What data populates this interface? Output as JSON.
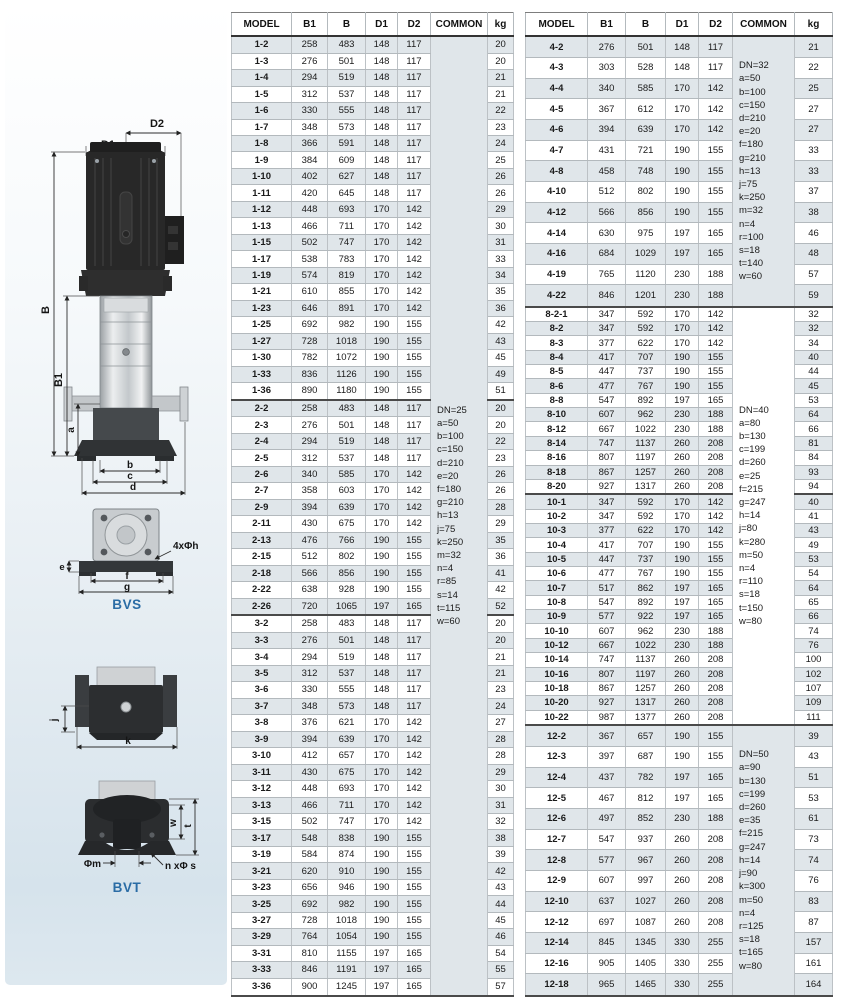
{
  "diagram": {
    "side_view": {
      "d2": "D2",
      "d1": "D1",
      "b": "B",
      "b1": "B1",
      "a": "a",
      "b_dim": "b",
      "c_dim": "c",
      "d_dim": "d"
    },
    "bvs": {
      "holes": "4xΦh",
      "e": "e",
      "f": "f",
      "g": "g",
      "label": "BVS"
    },
    "flange": {
      "j": "j",
      "k": "k"
    },
    "bvt": {
      "w": "w",
      "t": "t",
      "phi_m": "Φm",
      "n_phi_s": "n xΦ s",
      "label": "BVT"
    },
    "accent_color": "#2a6ca5"
  },
  "tables": [
    {
      "name": "left",
      "headers": [
        "MODEL",
        "B1",
        "B",
        "D1",
        "D2",
        "COMMON",
        "kg"
      ],
      "col_widths": [
        60,
        36,
        38,
        32,
        33,
        57,
        26
      ],
      "group_ends": [
        21,
        34
      ],
      "commons": [
        {
          "at": 0,
          "span": 58,
          "lines": [
            "DN=25",
            "a=50",
            "b=100",
            "c=150",
            "d=210",
            "e=20",
            "f=180",
            "g=210",
            "h=13",
            "j=75",
            "k=250",
            "m=32",
            "n=4",
            "r=85",
            "s=14",
            "t=115",
            "w=60"
          ]
        }
      ],
      "rows": [
        [
          "1-2",
          258,
          483,
          148,
          117,
          20
        ],
        [
          "1-3",
          276,
          501,
          148,
          117,
          20
        ],
        [
          "1-4",
          294,
          519,
          148,
          117,
          21
        ],
        [
          "1-5",
          312,
          537,
          148,
          117,
          21
        ],
        [
          "1-6",
          330,
          555,
          148,
          117,
          22
        ],
        [
          "1-7",
          348,
          573,
          148,
          117,
          23
        ],
        [
          "1-8",
          366,
          591,
          148,
          117,
          24
        ],
        [
          "1-9",
          384,
          609,
          148,
          117,
          25
        ],
        [
          "1-10",
          402,
          627,
          148,
          117,
          26
        ],
        [
          "1-11",
          420,
          645,
          148,
          117,
          26
        ],
        [
          "1-12",
          448,
          693,
          170,
          142,
          29
        ],
        [
          "1-13",
          466,
          711,
          170,
          142,
          30
        ],
        [
          "1-15",
          502,
          747,
          170,
          142,
          31
        ],
        [
          "1-17",
          538,
          783,
          170,
          142,
          33
        ],
        [
          "1-19",
          574,
          819,
          170,
          142,
          34
        ],
        [
          "1-21",
          610,
          855,
          170,
          142,
          35
        ],
        [
          "1-23",
          646,
          891,
          170,
          142,
          36
        ],
        [
          "1-25",
          692,
          982,
          190,
          155,
          42
        ],
        [
          "1-27",
          728,
          1018,
          190,
          155,
          43
        ],
        [
          "1-30",
          782,
          1072,
          190,
          155,
          45
        ],
        [
          "1-33",
          836,
          1126,
          190,
          155,
          49
        ],
        [
          "1-36",
          890,
          1180,
          190,
          155,
          51
        ],
        [
          "2-2",
          258,
          483,
          148,
          117,
          20
        ],
        [
          "2-3",
          276,
          501,
          148,
          117,
          20
        ],
        [
          "2-4",
          294,
          519,
          148,
          117,
          22
        ],
        [
          "2-5",
          312,
          537,
          148,
          117,
          23
        ],
        [
          "2-6",
          340,
          585,
          170,
          142,
          26
        ],
        [
          "2-7",
          358,
          603,
          170,
          142,
          26
        ],
        [
          "2-9",
          394,
          639,
          170,
          142,
          28
        ],
        [
          "2-11",
          430,
          675,
          170,
          142,
          29
        ],
        [
          "2-13",
          476,
          766,
          190,
          155,
          35
        ],
        [
          "2-15",
          512,
          802,
          190,
          155,
          36
        ],
        [
          "2-18",
          566,
          856,
          190,
          155,
          41
        ],
        [
          "2-22",
          638,
          928,
          190,
          155,
          42
        ],
        [
          "2-26",
          720,
          1065,
          197,
          165,
          52
        ],
        [
          "3-2",
          258,
          483,
          148,
          117,
          20
        ],
        [
          "3-3",
          276,
          501,
          148,
          117,
          20
        ],
        [
          "3-4",
          294,
          519,
          148,
          117,
          21
        ],
        [
          "3-5",
          312,
          537,
          148,
          117,
          21
        ],
        [
          "3-6",
          330,
          555,
          148,
          117,
          23
        ],
        [
          "3-7",
          348,
          573,
          148,
          117,
          24
        ],
        [
          "3-8",
          376,
          621,
          170,
          142,
          27
        ],
        [
          "3-9",
          394,
          639,
          170,
          142,
          28
        ],
        [
          "3-10",
          412,
          657,
          170,
          142,
          28
        ],
        [
          "3-11",
          430,
          675,
          170,
          142,
          29
        ],
        [
          "3-12",
          448,
          693,
          170,
          142,
          30
        ],
        [
          "3-13",
          466,
          711,
          170,
          142,
          31
        ],
        [
          "3-15",
          502,
          747,
          170,
          142,
          32
        ],
        [
          "3-17",
          548,
          838,
          190,
          155,
          38
        ],
        [
          "3-19",
          584,
          874,
          190,
          155,
          39
        ],
        [
          "3-21",
          620,
          910,
          190,
          155,
          42
        ],
        [
          "3-23",
          656,
          946,
          190,
          155,
          43
        ],
        [
          "3-25",
          692,
          982,
          190,
          155,
          44
        ],
        [
          "3-27",
          728,
          1018,
          190,
          155,
          45
        ],
        [
          "3-29",
          764,
          1054,
          190,
          155,
          46
        ],
        [
          "3-31",
          810,
          1155,
          197,
          165,
          54
        ],
        [
          "3-33",
          846,
          1191,
          197,
          165,
          55
        ],
        [
          "3-36",
          900,
          1245,
          197,
          165,
          57
        ]
      ]
    },
    {
      "name": "right",
      "headers": [
        "MODEL",
        "B1",
        "B",
        "D1",
        "D2",
        "COMMON",
        "kg"
      ],
      "col_widths": [
        62,
        38,
        40,
        33,
        34,
        62,
        38
      ],
      "group_ends": [
        12,
        25,
        41
      ],
      "commons": [
        {
          "at": 0,
          "span": 13,
          "lines": [
            "DN=32",
            "a=50",
            "b=100",
            "c=150",
            "d=210",
            "e=20",
            "f=180",
            "g=210",
            "h=13",
            "j=75",
            "k=250",
            "m=32",
            "n=4",
            "r=100",
            "s=18",
            "t=140",
            "w=60"
          ]
        },
        {
          "at": 13,
          "span": 29,
          "lines": [
            "DN=40",
            "a=80",
            "b=130",
            "c=199",
            "d=260",
            "e=25",
            "f=215",
            "g=247",
            "h=14",
            "j=80",
            "k=280",
            "m=50",
            "n=4",
            "r=110",
            "s=18",
            "t=150",
            "w=80"
          ]
        },
        {
          "at": 42,
          "span": 13,
          "lines": [
            "DN=50",
            "a=90",
            "b=130",
            "c=199",
            "d=260",
            "e=35",
            "f=215",
            "g=247",
            "h=14",
            "j=90",
            "k=300",
            "m=50",
            "n=4",
            "r=125",
            "s=18",
            "t=165",
            "w=80"
          ]
        }
      ],
      "rows": [
        [
          "4-2",
          276,
          501,
          148,
          117,
          21
        ],
        [
          "4-3",
          303,
          528,
          148,
          117,
          22
        ],
        [
          "4-4",
          340,
          585,
          170,
          142,
          25
        ],
        [
          "4-5",
          367,
          612,
          170,
          142,
          27
        ],
        [
          "4-6",
          394,
          639,
          170,
          142,
          27
        ],
        [
          "4-7",
          431,
          721,
          190,
          155,
          33
        ],
        [
          "4-8",
          458,
          748,
          190,
          155,
          33
        ],
        [
          "4-10",
          512,
          802,
          190,
          155,
          37
        ],
        [
          "4-12",
          566,
          856,
          190,
          155,
          38
        ],
        [
          "4-14",
          630,
          975,
          197,
          165,
          46
        ],
        [
          "4-16",
          684,
          1029,
          197,
          165,
          48
        ],
        [
          "4-19",
          765,
          1120,
          230,
          188,
          57
        ],
        [
          "4-22",
          846,
          1201,
          230,
          188,
          59
        ],
        [
          "8-2-1",
          347,
          592,
          170,
          142,
          32
        ],
        [
          "8-2",
          347,
          592,
          170,
          142,
          32
        ],
        [
          "8-3",
          377,
          622,
          170,
          142,
          34
        ],
        [
          "8-4",
          417,
          707,
          190,
          155,
          40
        ],
        [
          "8-5",
          447,
          737,
          190,
          155,
          44
        ],
        [
          "8-6",
          477,
          767,
          190,
          155,
          45
        ],
        [
          "8-8",
          547,
          892,
          197,
          165,
          53
        ],
        [
          "8-10",
          607,
          962,
          230,
          188,
          64
        ],
        [
          "8-12",
          667,
          1022,
          230,
          188,
          66
        ],
        [
          "8-14",
          747,
          1137,
          260,
          208,
          81
        ],
        [
          "8-16",
          807,
          1197,
          260,
          208,
          84
        ],
        [
          "8-18",
          867,
          1257,
          260,
          208,
          93
        ],
        [
          "8-20",
          927,
          1317,
          260,
          208,
          94
        ],
        [
          "10-1",
          347,
          592,
          170,
          142,
          40
        ],
        [
          "10-2",
          347,
          592,
          170,
          142,
          41
        ],
        [
          "10-3",
          377,
          622,
          170,
          142,
          43
        ],
        [
          "10-4",
          417,
          707,
          190,
          155,
          49
        ],
        [
          "10-5",
          447,
          737,
          190,
          155,
          53
        ],
        [
          "10-6",
          477,
          767,
          190,
          155,
          54
        ],
        [
          "10-7",
          517,
          862,
          197,
          165,
          64
        ],
        [
          "10-8",
          547,
          892,
          197,
          165,
          65
        ],
        [
          "10-9",
          577,
          922,
          197,
          165,
          66
        ],
        [
          "10-10",
          607,
          962,
          230,
          188,
          74
        ],
        [
          "10-12",
          667,
          1022,
          230,
          188,
          76
        ],
        [
          "10-14",
          747,
          1137,
          260,
          208,
          100
        ],
        [
          "10-16",
          807,
          1197,
          260,
          208,
          102
        ],
        [
          "10-18",
          867,
          1257,
          260,
          208,
          107
        ],
        [
          "10-20",
          927,
          1317,
          260,
          208,
          109
        ],
        [
          "10-22",
          987,
          1377,
          260,
          208,
          111
        ],
        [
          "12-2",
          367,
          657,
          190,
          155,
          39
        ],
        [
          "12-3",
          397,
          687,
          190,
          155,
          43
        ],
        [
          "12-4",
          437,
          782,
          197,
          165,
          51
        ],
        [
          "12-5",
          467,
          812,
          197,
          165,
          53
        ],
        [
          "12-6",
          497,
          852,
          230,
          188,
          61
        ],
        [
          "12-7",
          547,
          937,
          260,
          208,
          73
        ],
        [
          "12-8",
          577,
          967,
          260,
          208,
          74
        ],
        [
          "12-9",
          607,
          997,
          260,
          208,
          76
        ],
        [
          "12-10",
          637,
          1027,
          260,
          208,
          83
        ],
        [
          "12-12",
          697,
          1087,
          260,
          208,
          87
        ],
        [
          "12-14",
          845,
          1345,
          330,
          255,
          157
        ],
        [
          "12-16",
          905,
          1405,
          330,
          255,
          161
        ],
        [
          "12-18",
          965,
          1465,
          330,
          255,
          164
        ]
      ]
    }
  ]
}
